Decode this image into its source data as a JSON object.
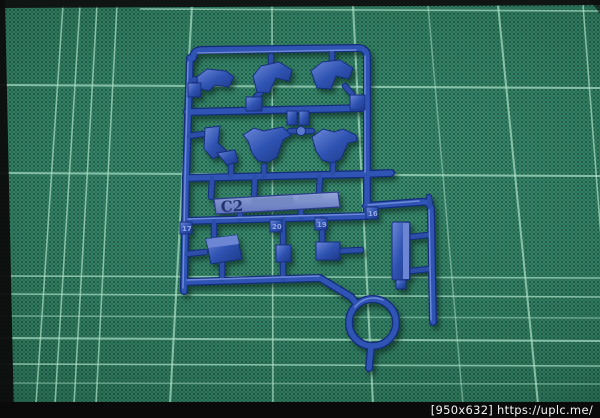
{
  "image": {
    "subject": "Blue plastic model-kit parts runner (sprue) lying on a green self-healing cutting mat",
    "mat_color": "#38886c",
    "mat_grid_color": "#a8dcc4",
    "plastic_color": "#2f55b5"
  },
  "sprue": {
    "label": "C2",
    "part_tags": [
      "17",
      "20",
      "19",
      "16"
    ]
  },
  "watermark": {
    "text": "[950x632] https://uplc.me/",
    "bar_color": "#0a0a0a",
    "text_color": "#f4f4f4"
  }
}
